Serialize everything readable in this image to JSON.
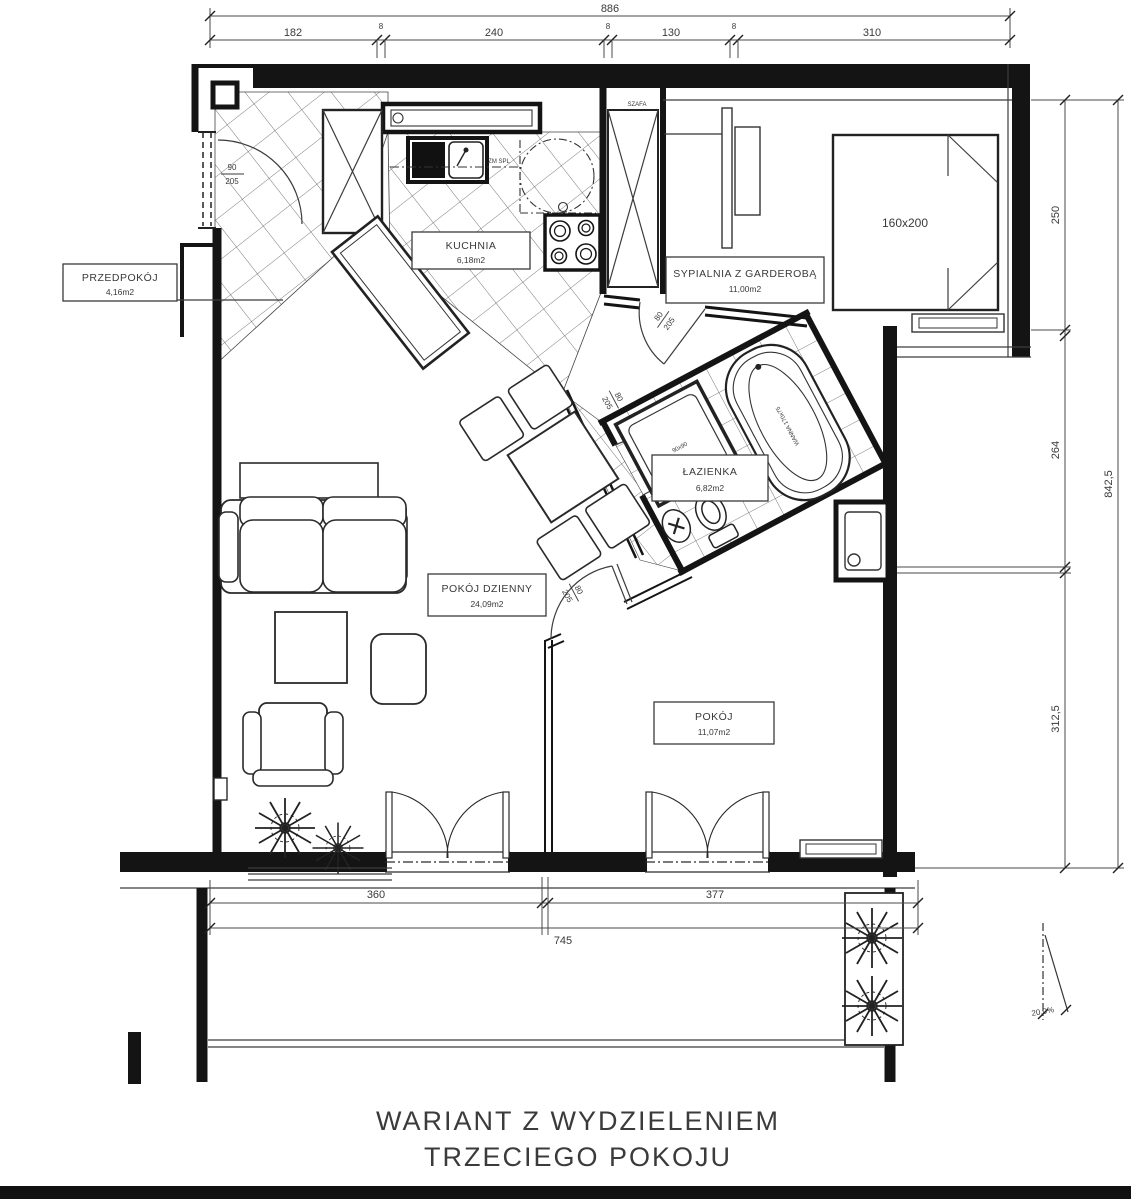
{
  "title": {
    "line1": "WARIANT Z WYDZIELENIEM",
    "line2": "TRZECIEGO POKOJU"
  },
  "rooms": [
    {
      "name": "PRZEDPOKÓJ",
      "area": "4,16m2"
    },
    {
      "name": "KUCHNIA",
      "area": "6,18m2"
    },
    {
      "name": "SYPIALNIA Z GARDEROBĄ",
      "area": "11,00m2"
    },
    {
      "name": "ŁAZIENKA",
      "area": "6,82m2"
    },
    {
      "name": "POKÓJ DZIENNY",
      "area": "24,09m2"
    },
    {
      "name": "POKÓJ",
      "area": "11,07m2"
    }
  ],
  "dims": {
    "top_total": "886",
    "top_segments": [
      "182",
      "8",
      "240",
      "8",
      "130",
      "8",
      "310"
    ],
    "right_total": "842,5",
    "right_segments": [
      "250",
      "264",
      "312,5"
    ],
    "bottom_segments": [
      "360",
      "377"
    ],
    "bottom_total": "745",
    "slope": "20,0%"
  },
  "fixtures": {
    "bed": "160x200",
    "wardrobe": "SZAFA",
    "bathtub": "WANNA 170x75",
    "shower": "90x90",
    "kitchen_note": "ZM SPL"
  },
  "doors": {
    "entrance": {
      "width": "90",
      "height": "205"
    },
    "interior": {
      "width": "80",
      "height": "205"
    }
  }
}
